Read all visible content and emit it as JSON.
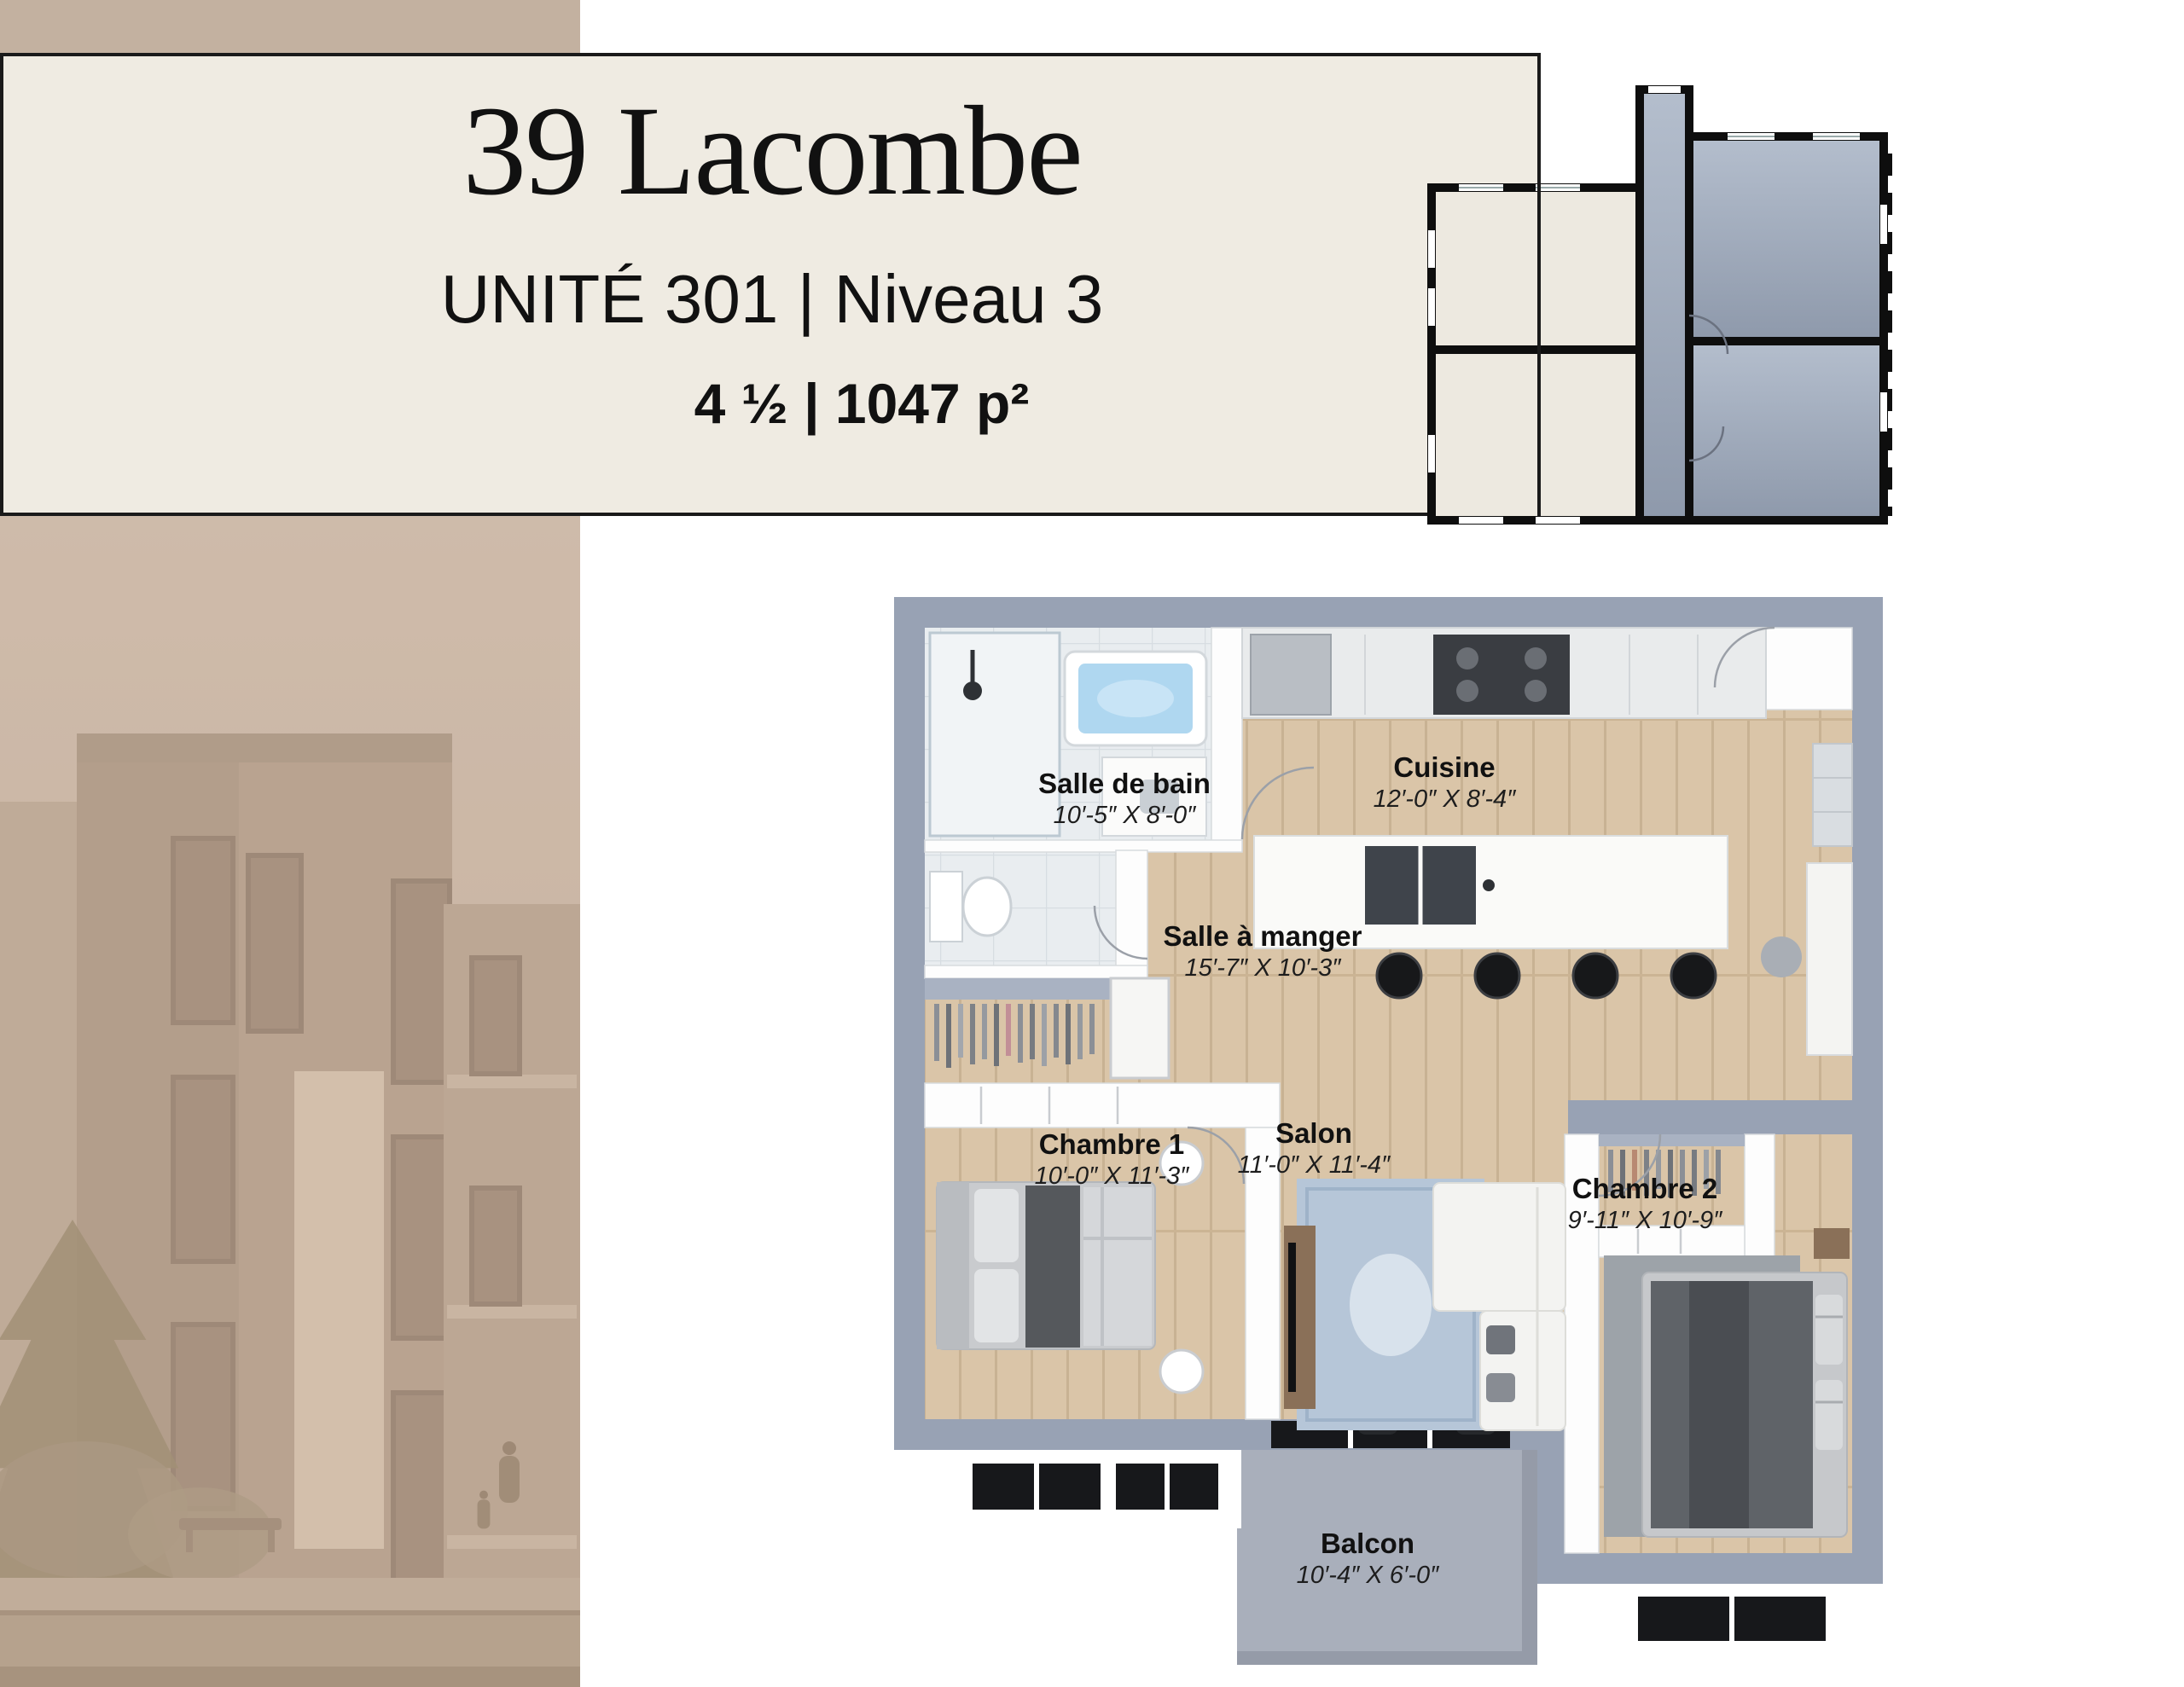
{
  "header": {
    "title": "39 Lacombe",
    "subtitle": "UNITÉ 301 | Niveau 3",
    "stats": "4 ½ | 1047 p²"
  },
  "floor_plan": {
    "rooms": [
      {
        "id": "salle-de-bain",
        "name": "Salle de bain",
        "dims": "10′-5″ X 8′-0″"
      },
      {
        "id": "cuisine",
        "name": "Cuisine",
        "dims": "12′-0″ X 8′-4″"
      },
      {
        "id": "salle-a-manger",
        "name": "Salle à manger",
        "dims": "15′-7″ X 10′-3″"
      },
      {
        "id": "chambre-1",
        "name": "Chambre 1",
        "dims": "10′-0″ X 11′-3″"
      },
      {
        "id": "salon",
        "name": "Salon",
        "dims": "11′-0″ X 11′-4″"
      },
      {
        "id": "chambre-2",
        "name": "Chambre 2",
        "dims": "9′-11″ X 10′-9″"
      },
      {
        "id": "balcon",
        "name": "Balcon",
        "dims": "10′-4″ X 6′-0″"
      }
    ]
  },
  "colors": {
    "card_bg": "#EFEBE2",
    "card_border": "#1A1A1A",
    "panel_tan": "#C3B1A0",
    "wall_grey": "#98A2B4",
    "wood_floor": "#DAC5A8",
    "tile_floor": "#E9EDF0",
    "keyplan_beige": "#EDE9E0",
    "keyplan_unit_light": "#B4BECD",
    "keyplan_unit_dark": "#8E99AB",
    "keyplan_wall": "#0E0E0E",
    "balcony_grey": "#A9AFBB",
    "rug_salon": "#B6C6D8",
    "rug_chambre2": "#9DA3A9",
    "text": "#111111"
  }
}
